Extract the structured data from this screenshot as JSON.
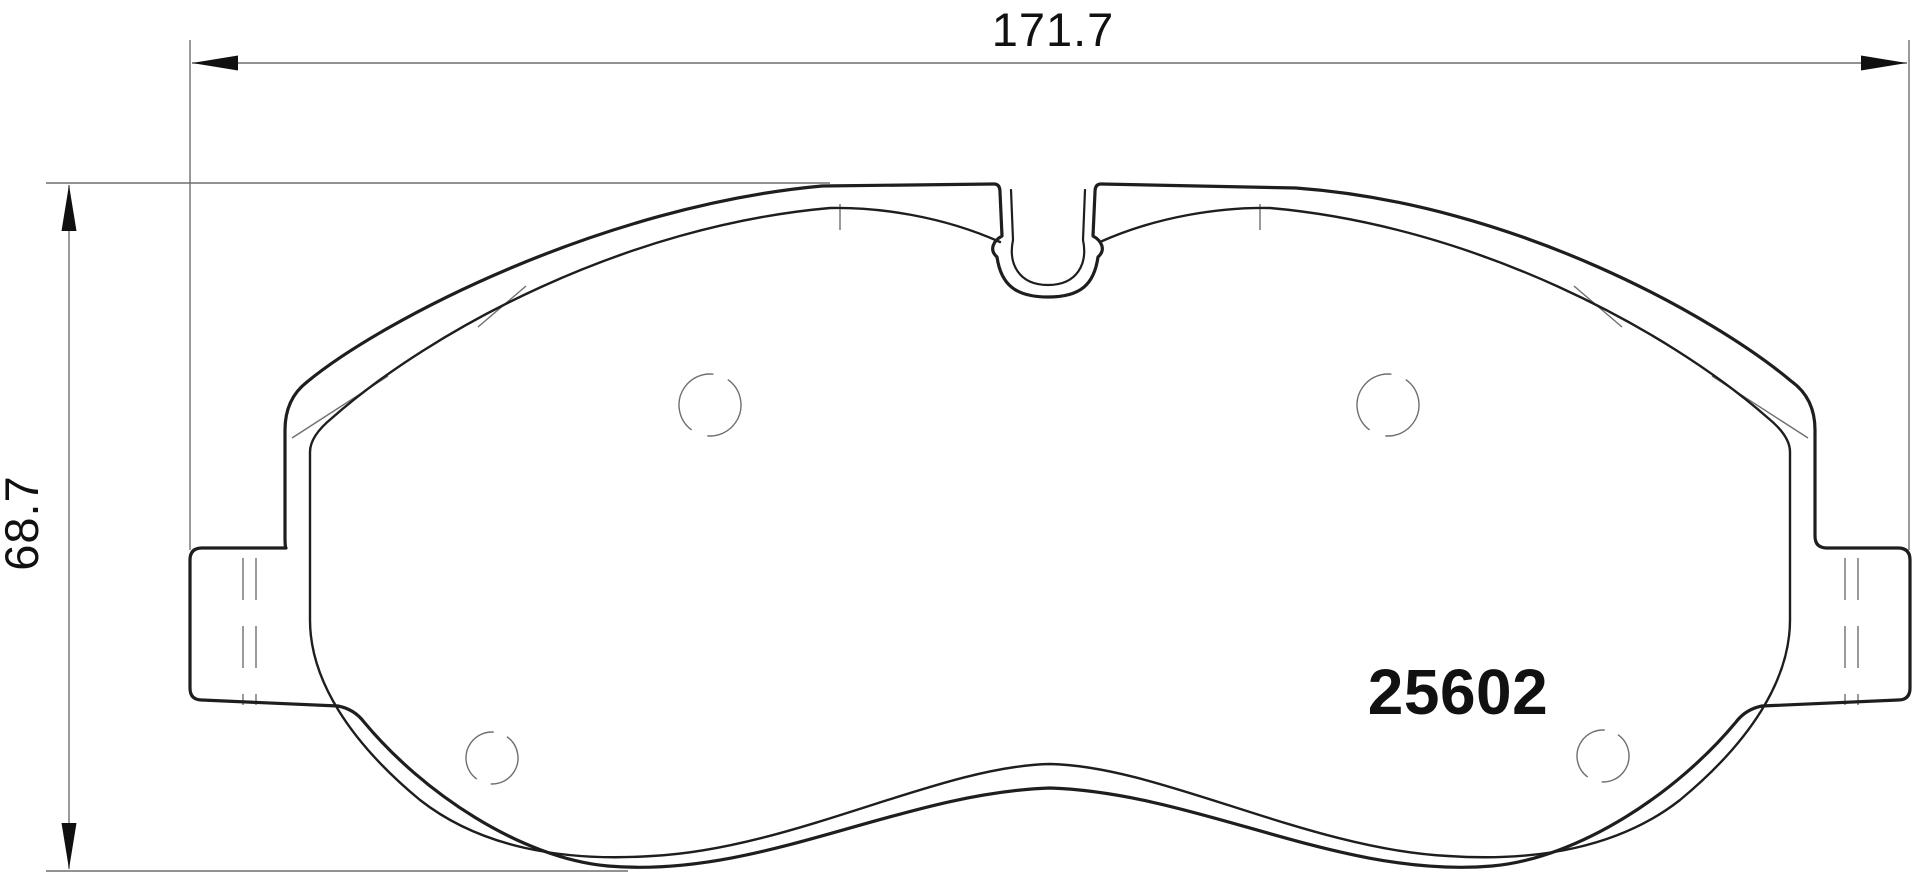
{
  "drawing": {
    "part_number": "25602",
    "width_dimension": "171.7",
    "height_dimension": "68.7"
  },
  "style": {
    "background_color": "#ffffff",
    "outline_color": "#1e1e1e",
    "inner_line_color": "#2b2b2b",
    "thin_line_color": "#6f6f6f",
    "text_color": "#101010"
  }
}
